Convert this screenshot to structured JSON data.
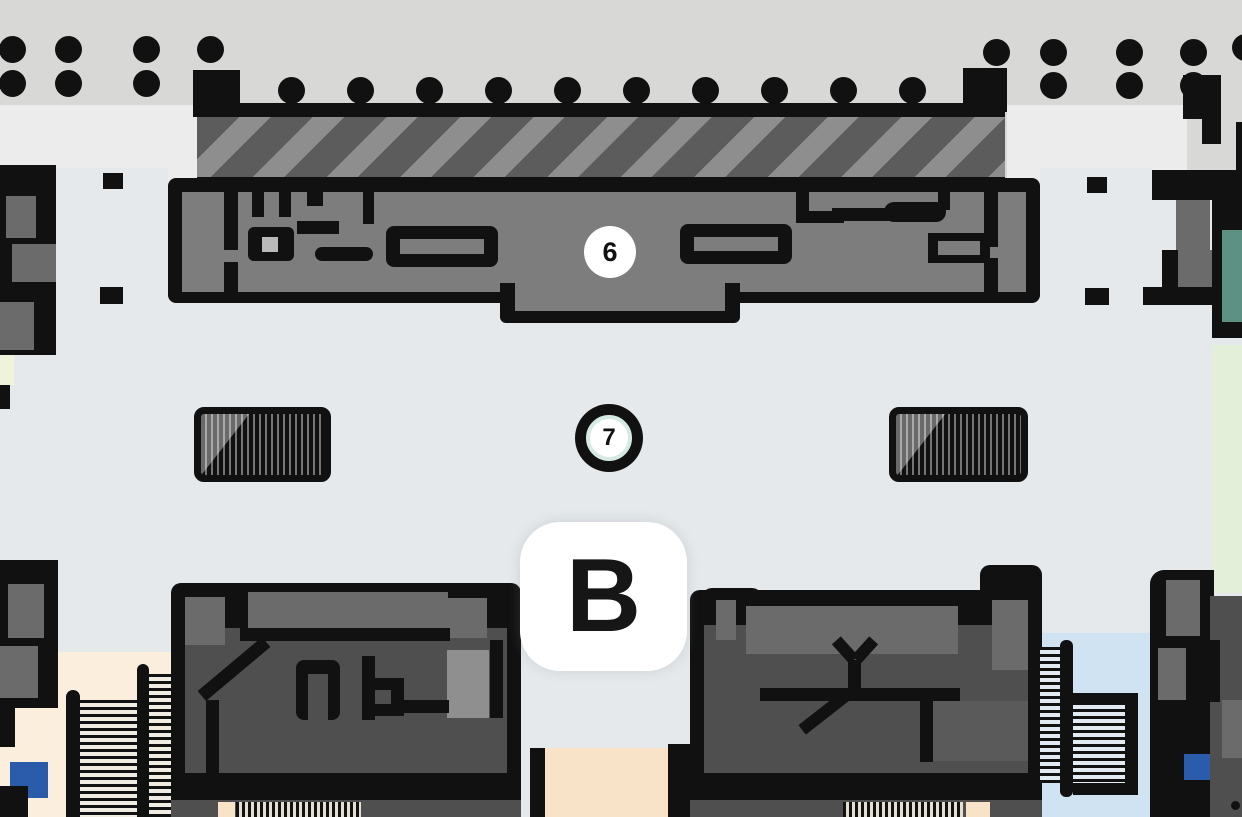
{
  "map": {
    "kind": "station-indoor-floorplan",
    "markers": [
      {
        "id": "exit-6",
        "label": "6",
        "shape": "white-circle"
      },
      {
        "id": "poi-7",
        "label": "7",
        "shape": "black-ring-circle"
      }
    ],
    "zone_label": "B"
  },
  "icons": {
    "column-dot-icon": "filled-black-circle",
    "platform-edge-icon": "diagonal-hatch-band",
    "stairs-icon": "striped-block-with-diagonal-highlight",
    "escalator-icon": "thin-horizontal-stripe-channel",
    "walkway-stripes-icon": "thin-vertical-stripe-band"
  },
  "colors": {
    "ink": "#111111",
    "topGray": "#d8d8d6",
    "topLight": "#ececec",
    "floor": "#e5e9eb",
    "concourse": "#7d7d7d",
    "roomGray": "#6b6b6b",
    "building": "#4f4f4f",
    "lightRoom": "#8f8f8f",
    "hatchDark": "#5c5c5c",
    "hatchLight": "#8e8e8e",
    "peach": "#fbeedd",
    "peachDeep": "#f8e3c9",
    "lightBlue": "#cfe3f2",
    "paleGreen": "#e4efda",
    "limeWhite": "#eef3da",
    "teal": "#5d9184",
    "blue": "#2a5cab",
    "mint": "#d5eae2",
    "white": "#ffffff"
  }
}
